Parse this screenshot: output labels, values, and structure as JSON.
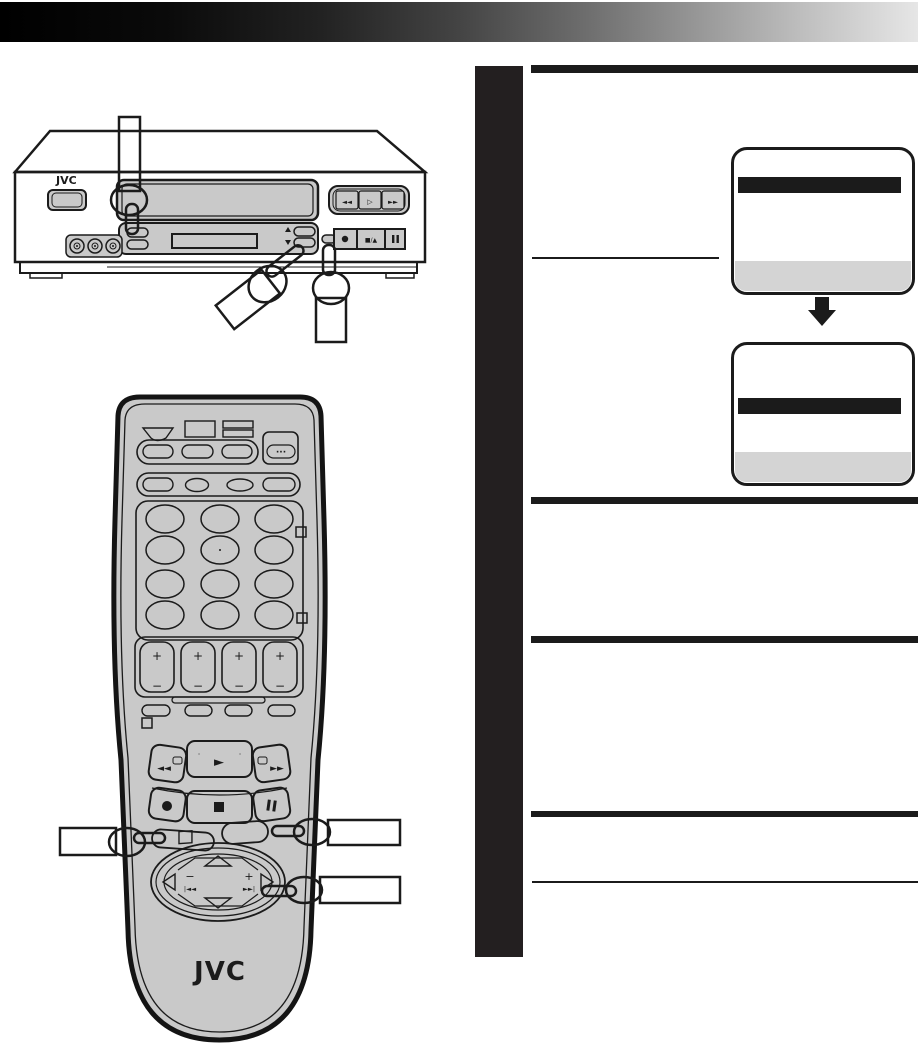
{
  "colors": {
    "ink": "#1b1b1b",
    "bodyGray": "#c9c9c9",
    "topGray": "#d6d6d6",
    "screenGray": "#d4d4d4"
  },
  "vcr": {
    "brand": "JVC",
    "transport_top": {
      "rew": "◄◄",
      "play": "▷",
      "ff": "►►"
    },
    "transport_bottom": {
      "stop_eject": "■/▲"
    },
    "channel": {
      "up": "▲",
      "down": "▼"
    }
  },
  "remote": {
    "brand": "JVC",
    "menu_dots": "···",
    "rocker": {
      "plus": "+",
      "minus": "−"
    },
    "transport": {
      "rew": "◄◄",
      "play": "►",
      "ff": "►►",
      "dot": "·"
    },
    "dpad": {
      "minus": "−",
      "plus": "+",
      "skip_back": "|◄◄",
      "skip_fwd": "►►|"
    }
  },
  "screens": [
    {
      "name": "menu-screen-1",
      "highlighted_row": "top",
      "footer_row": "gray"
    },
    {
      "name": "menu-screen-2",
      "highlighted_row": "middle",
      "footer_row": "gray"
    }
  ]
}
